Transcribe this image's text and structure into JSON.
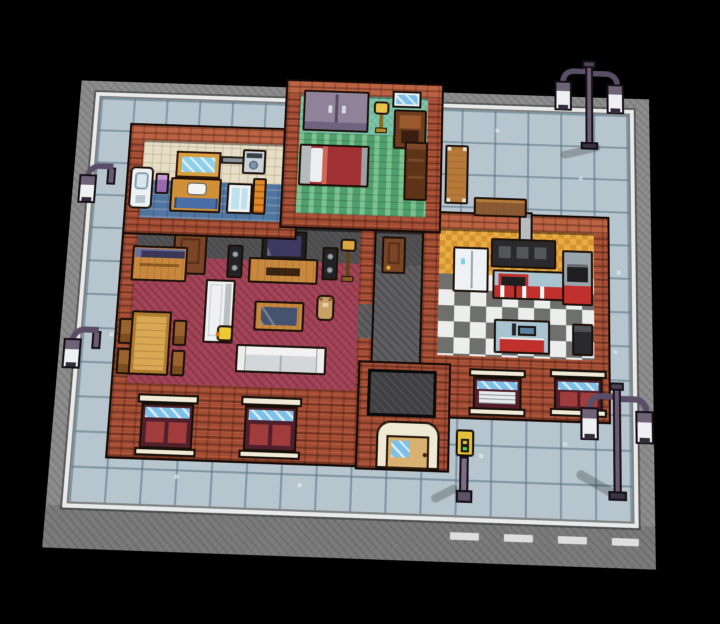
{
  "scene": {
    "label": "Top-down pixel-art street block with cutaway house interior",
    "background": "#000000"
  },
  "rooms": [
    {
      "id": "bathroom",
      "label": "Bathroom"
    },
    {
      "id": "bedroom",
      "label": "Bedroom"
    },
    {
      "id": "living_room",
      "label": "Living room"
    },
    {
      "id": "hallway",
      "label": "Hallway"
    },
    {
      "id": "kitchen",
      "label": "Kitchen"
    }
  ],
  "ground": {
    "sidewalk": {
      "label": "Sidewalk tiles"
    },
    "concrete": {
      "label": "Concrete apron"
    },
    "curb": {
      "label": "White curb"
    },
    "road": {
      "label": "Road lane dashes"
    },
    "scuffs": {
      "label": "Scuff marks"
    }
  },
  "objects": {
    "toilet": {
      "label": "Toilet"
    },
    "bathroom_bin": {
      "label": "Bathroom bin"
    },
    "wall_mirror": {
      "label": "Bathroom mirror"
    },
    "sink_vanity": {
      "label": "Sink vanity"
    },
    "washing_machine": {
      "label": "Washing machine"
    },
    "wall_pipe": {
      "label": "Wall pipe"
    },
    "shower": {
      "label": "Shower stall"
    },
    "towel": {
      "label": "Hanging towel"
    },
    "wardrobe": {
      "label": "Wardrobe"
    },
    "bedroom_lamp": {
      "label": "Bedroom floor lamp"
    },
    "bedroom_window": {
      "label": "Bedroom window"
    },
    "armchair": {
      "label": "Armchair"
    },
    "bed": {
      "label": "Bed"
    },
    "bookshelf": {
      "label": "Bookshelf"
    },
    "bedroom_door": {
      "label": "Bedroom door"
    },
    "bathroom_door": {
      "label": "Bathroom door"
    },
    "sideboard": {
      "label": "Sideboard"
    },
    "tv": {
      "label": "Television"
    },
    "tv_stand": {
      "label": "TV stand"
    },
    "speaker": {
      "label": "Speaker"
    },
    "living_lamp": {
      "label": "Living room floor lamp"
    },
    "dining_table": {
      "label": "Dining table"
    },
    "chair": {
      "label": "Dining chair"
    },
    "standing_mirror": {
      "label": "Standing mirror"
    },
    "rubber_duck": {
      "label": "Rubber duck"
    },
    "coffee_table": {
      "label": "Coffee table"
    },
    "teddy_bear": {
      "label": "Teddy bear"
    },
    "sofa": {
      "label": "Sofa"
    },
    "fridge": {
      "label": "Refrigerator"
    },
    "range_hood": {
      "label": "Range hood"
    },
    "chimney": {
      "label": "Chimney vent"
    },
    "stove_counter": {
      "label": "Stove counter"
    },
    "oven_unit": {
      "label": "Oven unit"
    },
    "sink_counter": {
      "label": "Kitchen sink counter"
    },
    "kitchen_bin": {
      "label": "Kitchen bin"
    },
    "window": {
      "label": "Front window"
    },
    "dark_window": {
      "label": "Large dark window"
    },
    "front_door": {
      "label": "Front door"
    },
    "bench": {
      "label": "Bench"
    },
    "street_lamp": {
      "label": "Street lamp"
    },
    "parking_meter": {
      "label": "Parking meter"
    }
  },
  "counts": {
    "street_lamps": 4,
    "benches": 2,
    "facade_windows": 4,
    "interior_doors": 2
  },
  "palette": {
    "background": "#000000",
    "sidewalk_tile": "#b6c5ce",
    "tile_seam": "#5b7382",
    "concrete": "#8b8b8b",
    "curb": "#e9ebeb",
    "brick": "#a44d34",
    "brick_light": "#bc6343",
    "outline": "#140a05",
    "bathroom_wall": "#e6ddc6",
    "bathroom_floor": "#50759f",
    "bedroom_wall": "#7fc7ab",
    "bedroom_floor": "#4f9e6e",
    "living_wall": "#4b4b4e",
    "living_floor": "#a34257",
    "hall_floor": "#606063",
    "kitchen_wall_a": "#e9ad45",
    "kitchen_wall_b": "#d69430",
    "kitchen_floor_a": "#eceded",
    "kitchen_floor_b": "#6f6f6d",
    "wood": "#c8893f",
    "wood_light": "#d8a855",
    "cabinet_red": "#c0302c",
    "counter_top": "#a8c4d0",
    "lamp_metal": "#6b5c72",
    "lantern_glass": "#eef0f2",
    "gold": "#d9b23a",
    "window_glass": "#7cc0e8"
  }
}
